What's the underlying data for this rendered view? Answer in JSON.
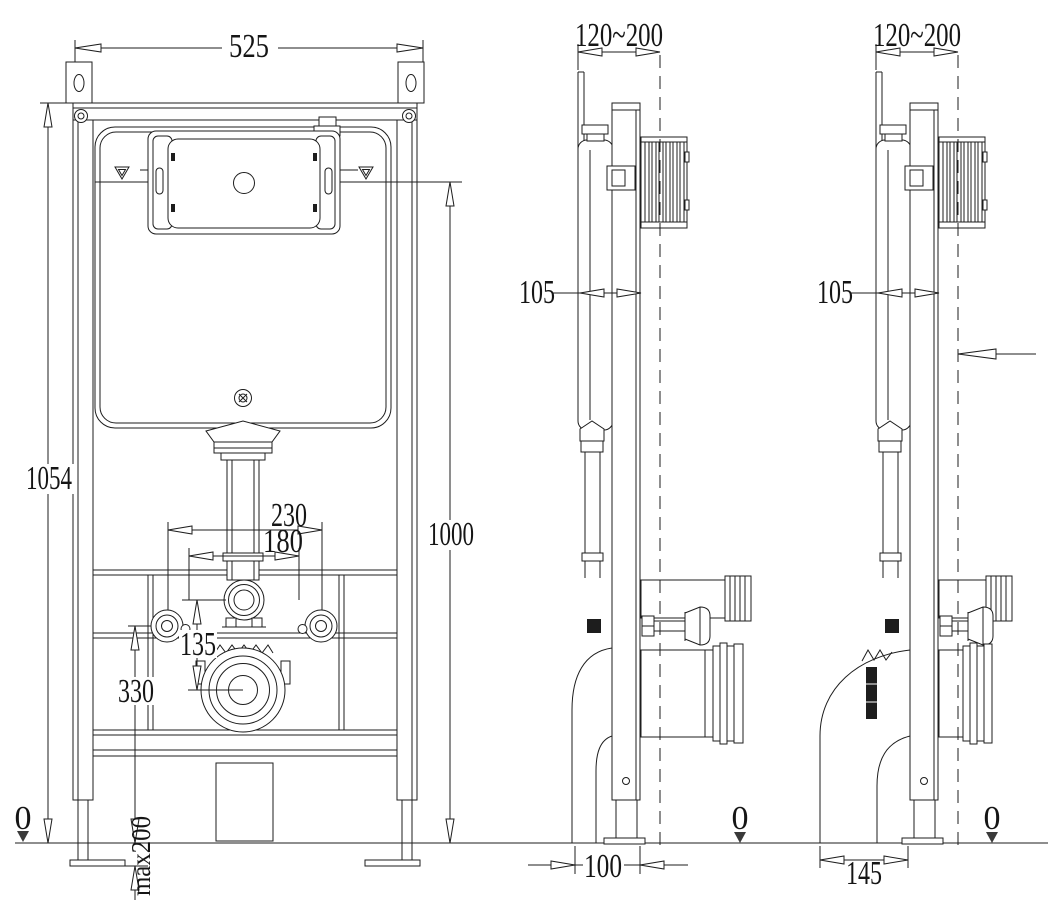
{
  "drawing": {
    "type": "installation technical drawing - concealed cistern wall-hung toilet frame",
    "palette": {
      "line": "#1d1d1d",
      "background": "#ffffff",
      "datum_fill": "#3a3a3a"
    }
  },
  "views": {
    "front": {
      "dim_width": "525",
      "dim_total_height": "1054",
      "dim_right_height": "1000",
      "dim_fixing_spacing_outer": "230",
      "dim_fixing_spacing_inner": "180",
      "dim_connector_offset": "135",
      "dim_outlet_height": "330",
      "dim_foot_adjustment": "max200",
      "datum": "0"
    },
    "side_a": {
      "dim_depth_range": "120~200",
      "dim_frame_depth": "105",
      "dim_outlet_offset": "100",
      "datum": "0"
    },
    "side_b": {
      "dim_depth_range": "120~200",
      "dim_frame_depth": "105",
      "dim_outlet_offset": "145",
      "datum": "0"
    }
  }
}
